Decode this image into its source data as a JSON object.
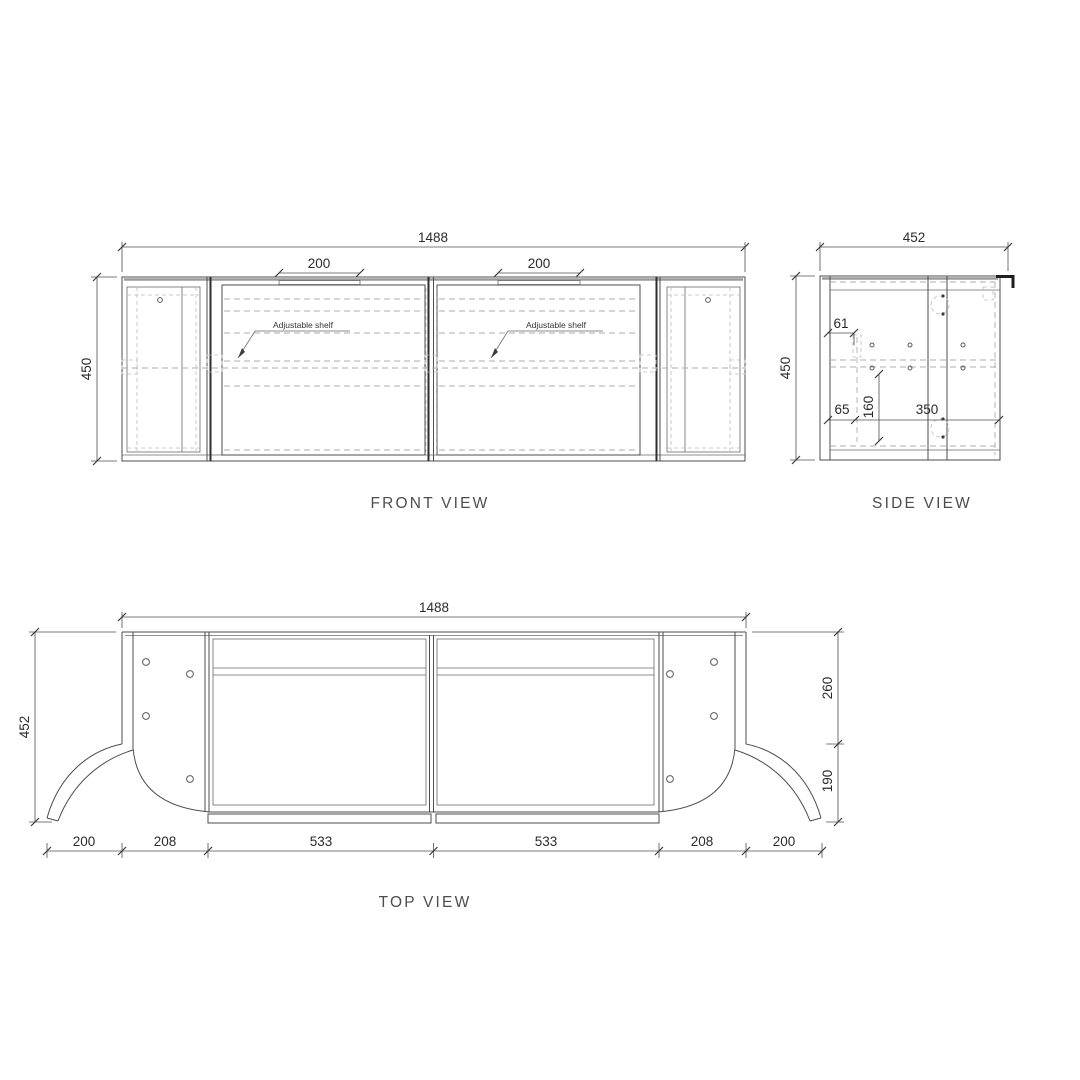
{
  "drawing": {
    "background": "#ffffff",
    "line_color": "#4d4d4d",
    "dash_color": "#aeaeae"
  },
  "front_view": {
    "title": "FRONT VIEW",
    "dim_width": "1488",
    "dim_height": "450",
    "dim_handle_left": "200",
    "dim_handle_right": "200",
    "shelf_label_left": "Adjustable shelf",
    "shelf_label_right": "Adjustable shelf"
  },
  "side_view": {
    "title": "SIDE VIEW",
    "dim_width": "452",
    "dim_height": "450",
    "dim_top_offset": "61",
    "dim_bottom_offset": "65",
    "dim_shelf_height": "160",
    "dim_inner_depth": "350"
  },
  "top_view": {
    "title": "TOP VIEW",
    "dim_width": "1488",
    "dim_depth": "452",
    "dim_side_back": "260",
    "dim_side_front": "190",
    "dim_bottom": [
      "200",
      "208",
      "533",
      "533",
      "208",
      "200"
    ]
  }
}
